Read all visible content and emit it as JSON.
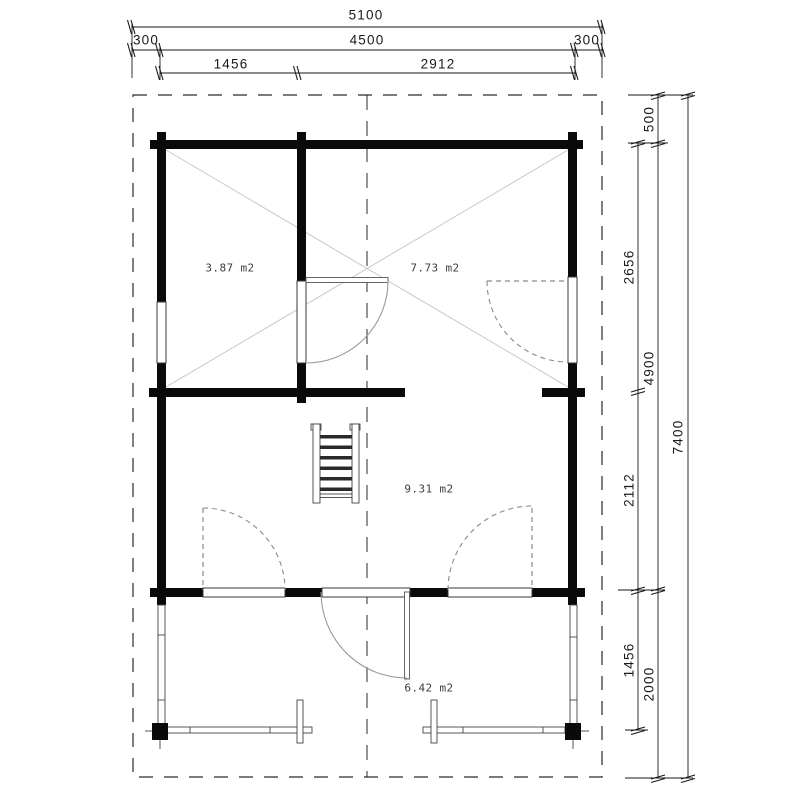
{
  "drawing_type": "cabin-floor-plan",
  "areas": {
    "upper_left_room": "3.87 m2",
    "upper_right_room": "7.73 m2",
    "main_room": "9.31 m2",
    "porch": "6.42 m2"
  },
  "dimensions": {
    "top": {
      "total": "5100",
      "left_overhang": "300",
      "width": "4500",
      "right_overhang": "300",
      "left_span": "1456",
      "right_span": "2912"
    },
    "right": {
      "top_overhang": "500",
      "upper_room_depth": "2656",
      "inner_height": "4900",
      "lower_room_depth": "2112",
      "porch_depth": "1456",
      "porch_overall": "2000",
      "total": "7400"
    }
  },
  "colors": {
    "wall": "#0a0a0a",
    "line": "#1a1a1a",
    "diagonal": "#c9c9c9",
    "door_arc": "#9a9a9a",
    "dashed_feature": "#8a8a8a",
    "area_label": "#3d3d42",
    "background": "#ffffff"
  }
}
